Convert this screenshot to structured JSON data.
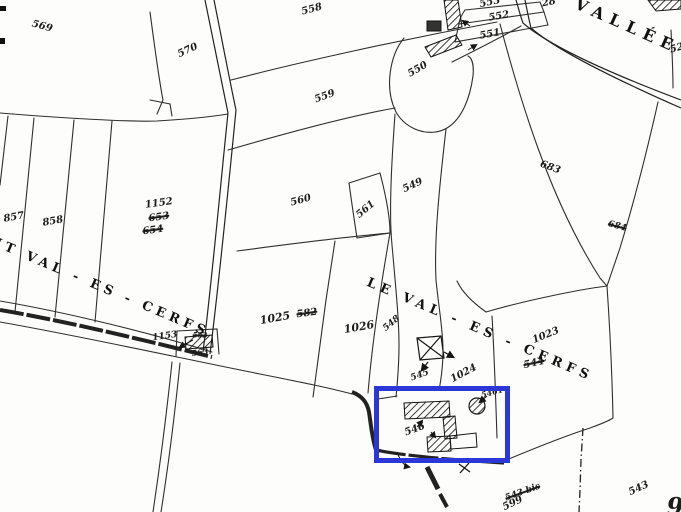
{
  "map": {
    "title": "cadastral-parcel-map",
    "background_color": "#fdfdfb",
    "line_color": "#2e2e2e",
    "building_color": "#111111",
    "highlight": {
      "color": "#2c37d7",
      "x": 374,
      "y": 386,
      "w": 136,
      "h": 77
    },
    "place_names": [
      {
        "id": "vallee",
        "text": "VALLÉE",
        "x": 627,
        "y": 26,
        "rot": 24,
        "size": 16,
        "spacing": 7
      },
      {
        "id": "petit-val-es-cerfs",
        "text": "IT  VAL - ES - CERFS",
        "x": 102,
        "y": 288,
        "rot": 23,
        "size": 13,
        "spacing": 4.5
      },
      {
        "id": "le-val-es-cerfs",
        "text": "LE  VAL - ES - CERFS",
        "x": 480,
        "y": 330,
        "rot": 23,
        "size": 13,
        "spacing": 5
      }
    ],
    "parcel_labels": [
      {
        "text": "569",
        "x": 42,
        "y": 27,
        "rot": 15
      },
      {
        "text": "570",
        "x": 188,
        "y": 51,
        "rot": -25
      },
      {
        "text": "558",
        "x": 312,
        "y": 10,
        "rot": -15
      },
      {
        "text": "553",
        "x": 490,
        "y": 3,
        "rot": -12
      },
      {
        "text": "28",
        "x": 549,
        "y": 3,
        "rot": -12
      },
      {
        "text": "552",
        "x": 499,
        "y": 17,
        "rot": -10
      },
      {
        "text": "551",
        "x": 490,
        "y": 35,
        "rot": -10
      },
      {
        "text": "550",
        "x": 418,
        "y": 70,
        "rot": -30
      },
      {
        "text": "559",
        "x": 325,
        "y": 97,
        "rot": -20
      },
      {
        "text": "52",
        "x": 677,
        "y": 49,
        "rot": -15
      },
      {
        "text": "560",
        "x": 301,
        "y": 201,
        "rot": -15
      },
      {
        "text": "561",
        "x": 366,
        "y": 210,
        "rot": -40
      },
      {
        "text": "549",
        "x": 413,
        "y": 186,
        "rot": -25
      },
      {
        "text": "683",
        "x": 550,
        "y": 168,
        "rot": 20
      },
      {
        "text": "684",
        "x": 617,
        "y": 227,
        "rot": 15,
        "struck": true,
        "size": 9
      },
      {
        "text": "1152",
        "x": 159,
        "y": 204,
        "rot": -8
      },
      {
        "text": "653",
        "x": 159,
        "y": 218,
        "rot": -8,
        "struck": true
      },
      {
        "text": "654",
        "x": 153,
        "y": 231,
        "rot": -8,
        "struck": true
      },
      {
        "text": "857",
        "x": 14,
        "y": 218,
        "rot": -10
      },
      {
        "text": "858",
        "x": 53,
        "y": 222,
        "rot": -10
      },
      {
        "text": "1153",
        "x": 165,
        "y": 337,
        "rot": -8,
        "size": 9
      },
      {
        "text": "562",
        "x": 200,
        "y": 335,
        "rot": 0,
        "struck": true,
        "size": 7
      },
      {
        "text": "563",
        "x": 200,
        "y": 352,
        "rot": -8,
        "size": 8
      },
      {
        "text": "1025",
        "x": 275,
        "y": 318,
        "rot": -10,
        "size": 11
      },
      {
        "text": "582",
        "x": 307,
        "y": 314,
        "rot": -8,
        "struck": true
      },
      {
        "text": "1026",
        "x": 359,
        "y": 327,
        "rot": -10,
        "size": 11
      },
      {
        "text": "548",
        "x": 392,
        "y": 324,
        "rot": -40,
        "size": 9
      },
      {
        "text": "1023",
        "x": 546,
        "y": 336,
        "rot": -22
      },
      {
        "text": "544",
        "x": 534,
        "y": 364,
        "rot": -12,
        "struck": true
      },
      {
        "text": "1024",
        "x": 464,
        "y": 374,
        "rot": -28
      },
      {
        "text": "545",
        "x": 420,
        "y": 376,
        "rot": -20,
        "size": 9
      },
      {
        "text": "5461",
        "x": 492,
        "y": 392,
        "rot": -15,
        "size": 8
      },
      {
        "text": "546",
        "x": 415,
        "y": 430,
        "rot": -20
      },
      {
        "text": "543 bis",
        "x": 523,
        "y": 493,
        "rot": -20,
        "struck": true,
        "size": 9
      },
      {
        "text": "599",
        "x": 513,
        "y": 504,
        "rot": -25
      },
      {
        "text": "543",
        "x": 639,
        "y": 489,
        "rot": -25
      },
      {
        "text": "9",
        "x": 675,
        "y": 507,
        "rot": 0,
        "size": 24
      }
    ],
    "symbols": [
      {
        "id": "mutation-cross-square",
        "desc": "square with X diagonals",
        "x": 430,
        "y": 348
      },
      {
        "id": "well-circle",
        "desc": "hatched circle",
        "x": 477,
        "y": 406
      },
      {
        "id": "x-mark",
        "x": 464,
        "y": 468
      },
      {
        "id": "edge-mark-top",
        "x": 2,
        "y": 8
      },
      {
        "id": "edge-mark-lower",
        "x": 2,
        "y": 40
      }
    ]
  }
}
